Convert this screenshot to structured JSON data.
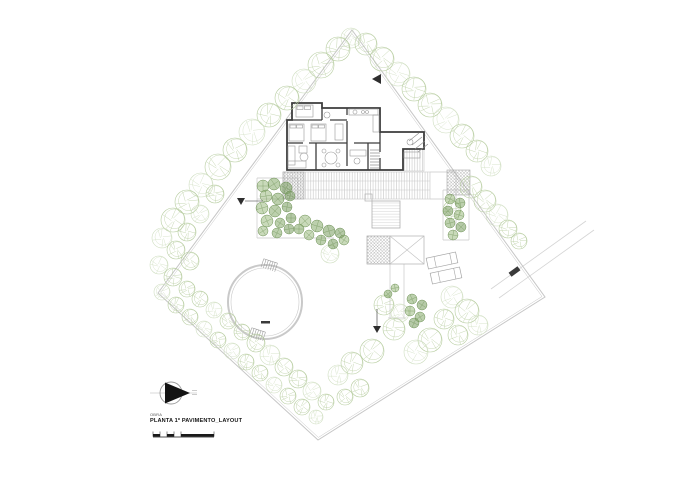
{
  "titleblock": {
    "small_label": "OBRA",
    "title": "PLANTA 1º PAVIMENTO_LAYOUT"
  },
  "plan": {
    "colors": {
      "boundary": "#c6c6c6",
      "light": "#c9c9c9",
      "wall": "#3d3d3d",
      "furniture": "#9a9a9a",
      "tree": "#b7cda0",
      "tree2": "#cfdec0",
      "shrub": [
        "#9dbb82",
        "#85a96a",
        "#789c5e"
      ],
      "shrubStroke": "#6d9055",
      "dark": "#2e2e2e",
      "hatch": "#9a9a9a"
    },
    "boundary": [
      [
        352,
        30
      ],
      [
        545,
        297
      ],
      [
        318,
        440
      ],
      [
        158,
        293
      ]
    ],
    "road": [
      [
        491,
        289,
        586,
        221
      ],
      [
        499,
        298,
        594,
        230
      ]
    ],
    "terrace_lines": [
      [
        257,
        178,
        298,
        178
      ],
      [
        257,
        178,
        257,
        238
      ],
      [
        257,
        238,
        334,
        238
      ],
      [
        298,
        178,
        298,
        199
      ],
      [
        257,
        199,
        283,
        199
      ],
      [
        430,
        199,
        456,
        199
      ],
      [
        456,
        172,
        456,
        232
      ],
      [
        430,
        172,
        456,
        172
      ],
      [
        443,
        190,
        469,
        190
      ],
      [
        443,
        190,
        443,
        240
      ],
      [
        469,
        190,
        469,
        240
      ],
      [
        443,
        240,
        469,
        240
      ],
      [
        390,
        264,
        390,
        318
      ],
      [
        404,
        264,
        404,
        318
      ],
      [
        388,
        318,
        406,
        318
      ]
    ],
    "deck": {
      "main": [
        283,
        172,
        147,
        27
      ],
      "right": [
        404,
        149,
        20,
        22
      ],
      "cross": [
        283,
        172,
        21,
        27
      ],
      "right_hatch": [
        447,
        170,
        23,
        25
      ],
      "dividers": [
        [
          283,
          181,
          430,
          181
        ],
        [
          283,
          190,
          430,
          190
        ]
      ]
    },
    "spa": {
      "rect": [
        372,
        201,
        28,
        27
      ],
      "small": [
        365,
        194,
        7,
        7
      ]
    },
    "squares": {
      "hatched": [
        367,
        236,
        23,
        28
      ],
      "x": [
        390,
        236,
        34,
        28
      ],
      "x_lines": [
        [
          390,
          236,
          424,
          264
        ],
        [
          390,
          264,
          424,
          236
        ]
      ]
    },
    "house": {
      "outline": "M292,103 L322,103 L322,108 L380,108 L380,132 L424,132 L424,149 L403,149 L403,170 L287,170 L287,120 L292,120 Z",
      "walls": [
        [
          292,
          120,
          322,
          120
        ],
        [
          322,
          108,
          322,
          120
        ],
        [
          287,
          143,
          303,
          143
        ],
        [
          309,
          143,
          347,
          143
        ],
        [
          354,
          143,
          380,
          143
        ],
        [
          347,
          108,
          347,
          115
        ],
        [
          347,
          121,
          347,
          143
        ],
        [
          330,
          120,
          347,
          120
        ],
        [
          316,
          143,
          316,
          170
        ],
        [
          347,
          143,
          347,
          166
        ],
        [
          368,
          143,
          368,
          170
        ],
        [
          380,
          132,
          380,
          152
        ],
        [
          380,
          158,
          380,
          170
        ]
      ],
      "entry_steps": [
        [
          409,
          141,
          419,
          133
        ],
        [
          412,
          145,
          422,
          137
        ],
        [
          415,
          149,
          425,
          141
        ],
        [
          418,
          152,
          428,
          144
        ]
      ],
      "stairs": {
        "x1": 370,
        "x2": 380,
        "y": 150,
        "n": 7,
        "dy": 3
      }
    },
    "furniture": {
      "rects": [
        [
          296,
          105,
          17,
          12
        ],
        [
          297,
          106,
          6,
          3.5
        ],
        [
          304.5,
          106,
          6,
          3.5
        ],
        [
          289,
          124,
          15,
          17
        ],
        [
          290,
          125,
          6,
          3
        ],
        [
          296.5,
          125,
          6,
          3
        ],
        [
          311,
          124,
          15,
          17
        ],
        [
          312,
          125,
          6,
          3
        ],
        [
          318.5,
          125,
          6,
          3
        ],
        [
          335,
          124,
          8,
          16
        ],
        [
          288,
          146,
          7,
          19
        ],
        [
          288,
          161,
          18,
          7
        ],
        [
          299,
          146,
          8,
          7
        ],
        [
          350,
          150,
          16,
          6
        ],
        [
          349,
          109,
          29,
          6
        ],
        [
          373,
          115,
          6,
          17
        ],
        [
          404,
          152,
          16,
          6
        ]
      ],
      "circles": [
        [
          304,
          157,
          4
        ],
        [
          331,
          158,
          6
        ],
        [
          324,
          151,
          2
        ],
        [
          338,
          151,
          2
        ],
        [
          324,
          165,
          2
        ],
        [
          338,
          165,
          2
        ],
        [
          357,
          161,
          3
        ],
        [
          355,
          112,
          2
        ],
        [
          363,
          112,
          1.5
        ],
        [
          367,
          112,
          1.5
        ],
        [
          327,
          115,
          3
        ],
        [
          410,
          142,
          3
        ]
      ]
    },
    "pool": {
      "cx": 265,
      "cy": 302,
      "r": 37,
      "r2": 34,
      "mark": [
        261,
        321,
        9,
        2.5
      ],
      "ladders": [
        {
          "x": 262,
          "y": 261,
          "rot": 18
        },
        {
          "x": 250,
          "y": 330,
          "rot": 18
        }
      ]
    },
    "loungers": [
      {
        "x": 427,
        "y": 255,
        "rot": -12
      },
      {
        "x": 431,
        "y": 270,
        "rot": -12
      }
    ],
    "markers": {
      "entry_tri": "381,74 381,84 372,79",
      "level_tri": "237,198 245,198 241,205",
      "level_line": [
        245,
        201,
        263,
        201
      ],
      "dir_line": [
        377,
        309,
        377,
        326
      ],
      "dir_tri": "373,326 381,326 377,333",
      "car": {
        "x": 509,
        "y": 269,
        "w": 11,
        "h": 5,
        "rot": -36
      }
    },
    "trees": [
      [
        351,
        38,
        10
      ],
      [
        338,
        49,
        12
      ],
      [
        321,
        65,
        13
      ],
      [
        304,
        81,
        12
      ],
      [
        287,
        98,
        12
      ],
      [
        269,
        115,
        12
      ],
      [
        252,
        132,
        13
      ],
      [
        235,
        150,
        12
      ],
      [
        218,
        167,
        13
      ],
      [
        201,
        185,
        12
      ],
      [
        215,
        194,
        9
      ],
      [
        187,
        202,
        12
      ],
      [
        200,
        214,
        9
      ],
      [
        173,
        220,
        12
      ],
      [
        187,
        232,
        9
      ],
      [
        162,
        238,
        10
      ],
      [
        176,
        250,
        9
      ],
      [
        190,
        261,
        9
      ],
      [
        159,
        265,
        9
      ],
      [
        173,
        277,
        9
      ],
      [
        187,
        289,
        8
      ],
      [
        162,
        292,
        8
      ],
      [
        200,
        299,
        8
      ],
      [
        176,
        305,
        8
      ],
      [
        214,
        310,
        8
      ],
      [
        190,
        317,
        8
      ],
      [
        228,
        321,
        8
      ],
      [
        204,
        329,
        8
      ],
      [
        242,
        332,
        8
      ],
      [
        218,
        340,
        8
      ],
      [
        232,
        351,
        8
      ],
      [
        256,
        343,
        9
      ],
      [
        246,
        362,
        8
      ],
      [
        270,
        355,
        10
      ],
      [
        260,
        373,
        8
      ],
      [
        284,
        367,
        9
      ],
      [
        274,
        385,
        8
      ],
      [
        298,
        379,
        9
      ],
      [
        288,
        396,
        8
      ],
      [
        312,
        391,
        9
      ],
      [
        302,
        407,
        8
      ],
      [
        326,
        402,
        8
      ],
      [
        316,
        417,
        7
      ],
      [
        366,
        44,
        11
      ],
      [
        382,
        59,
        12
      ],
      [
        398,
        74,
        12
      ],
      [
        414,
        89,
        12
      ],
      [
        430,
        105,
        12
      ],
      [
        446,
        120,
        13
      ],
      [
        462,
        136,
        12
      ],
      [
        477,
        151,
        11
      ],
      [
        491,
        166,
        10
      ],
      [
        471,
        187,
        11
      ],
      [
        485,
        201,
        11
      ],
      [
        497,
        215,
        11
      ],
      [
        508,
        229,
        9
      ],
      [
        519,
        241,
        8
      ],
      [
        452,
        297,
        11
      ],
      [
        467,
        311,
        12
      ],
      [
        444,
        319,
        10
      ],
      [
        478,
        325,
        10
      ],
      [
        458,
        335,
        10
      ],
      [
        430,
        340,
        12
      ],
      [
        416,
        352,
        12
      ],
      [
        394,
        329,
        11
      ],
      [
        384,
        305,
        10
      ],
      [
        400,
        313,
        9
      ],
      [
        372,
        351,
        12
      ],
      [
        352,
        363,
        11
      ],
      [
        338,
        375,
        10
      ],
      [
        360,
        388,
        9
      ],
      [
        345,
        397,
        8
      ],
      [
        330,
        254,
        9
      ],
      [
        452,
        210,
        9
      ]
    ],
    "shrubs": [
      [
        263,
        186,
        6
      ],
      [
        274,
        184,
        6
      ],
      [
        286,
        188,
        6
      ],
      [
        266,
        196,
        6
      ],
      [
        278,
        199,
        6
      ],
      [
        290,
        196,
        5
      ],
      [
        262,
        208,
        6
      ],
      [
        275,
        211,
        6
      ],
      [
        287,
        207,
        5
      ],
      [
        267,
        221,
        6
      ],
      [
        280,
        223,
        5
      ],
      [
        291,
        218,
        5
      ],
      [
        263,
        231,
        5
      ],
      [
        277,
        233,
        5
      ],
      [
        289,
        229,
        5
      ],
      [
        305,
        221,
        6
      ],
      [
        317,
        226,
        6
      ],
      [
        329,
        231,
        6
      ],
      [
        309,
        235,
        5
      ],
      [
        321,
        240,
        5
      ],
      [
        333,
        244,
        5
      ],
      [
        344,
        240,
        5
      ],
      [
        299,
        229,
        5
      ],
      [
        340,
        233,
        5
      ],
      [
        450,
        199,
        5
      ],
      [
        460,
        203,
        5
      ],
      [
        448,
        211,
        5
      ],
      [
        459,
        215,
        5
      ],
      [
        450,
        223,
        5
      ],
      [
        461,
        227,
        5
      ],
      [
        453,
        235,
        5
      ],
      [
        412,
        299,
        5
      ],
      [
        422,
        305,
        5
      ],
      [
        410,
        311,
        5
      ],
      [
        420,
        317,
        5
      ],
      [
        414,
        323,
        5
      ],
      [
        395,
        288,
        4
      ],
      [
        388,
        294,
        4
      ]
    ],
    "north": {
      "cx": 171,
      "cy": 393,
      "r": 11
    },
    "scalebar": {
      "x": 153,
      "y": 434,
      "h": 2.6,
      "baseline_w": 61,
      "rects": [
        [
          0,
          7
        ],
        [
          14,
          7
        ],
        [
          28,
          33
        ]
      ],
      "ticks": [
        0,
        7,
        14,
        21,
        28,
        61
      ]
    }
  }
}
